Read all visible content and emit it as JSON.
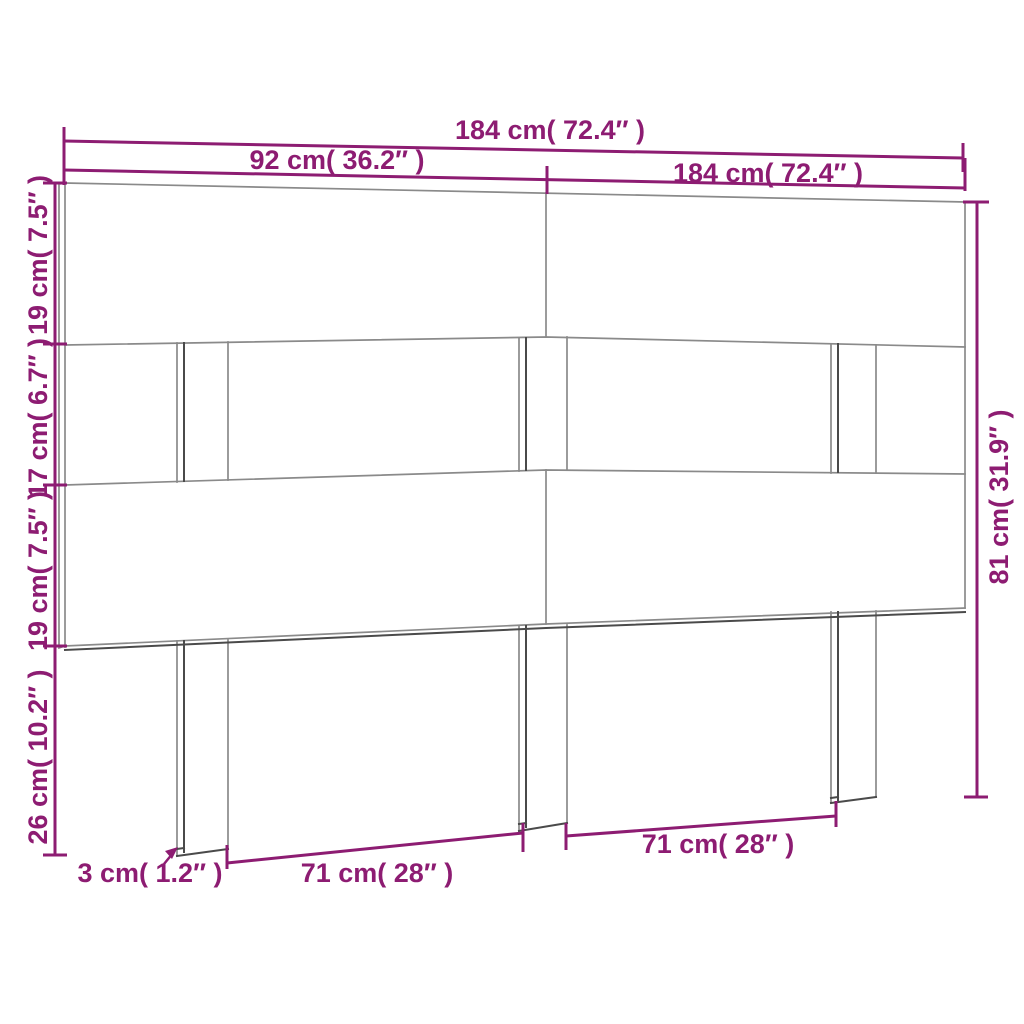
{
  "title": "Headboard dimension diagram",
  "colors": {
    "dimension": "#8d1c72",
    "outline_light": "#8a8a8a",
    "outline_dark": "#4a4a4a",
    "background": "#ffffff"
  },
  "labels": {
    "total_width_top": "184 cm( 72.4″ )",
    "half_width": "92 cm( 36.2″ )",
    "total_width_right": "184 cm( 72.4″ )",
    "top_board_height": "19 cm( 7.5″ )",
    "gap_height": "17 cm( 6.7″ )",
    "middle_board_height": "19 cm( 7.5″ )",
    "legs_height": "26 cm( 10.2″ )",
    "total_height": "81 cm( 31.9″ )",
    "board_thickness": "3 cm( 1.2″ )",
    "leg_span_left": "71 cm( 28″ )",
    "leg_span_right": "71 cm( 28″ )"
  }
}
